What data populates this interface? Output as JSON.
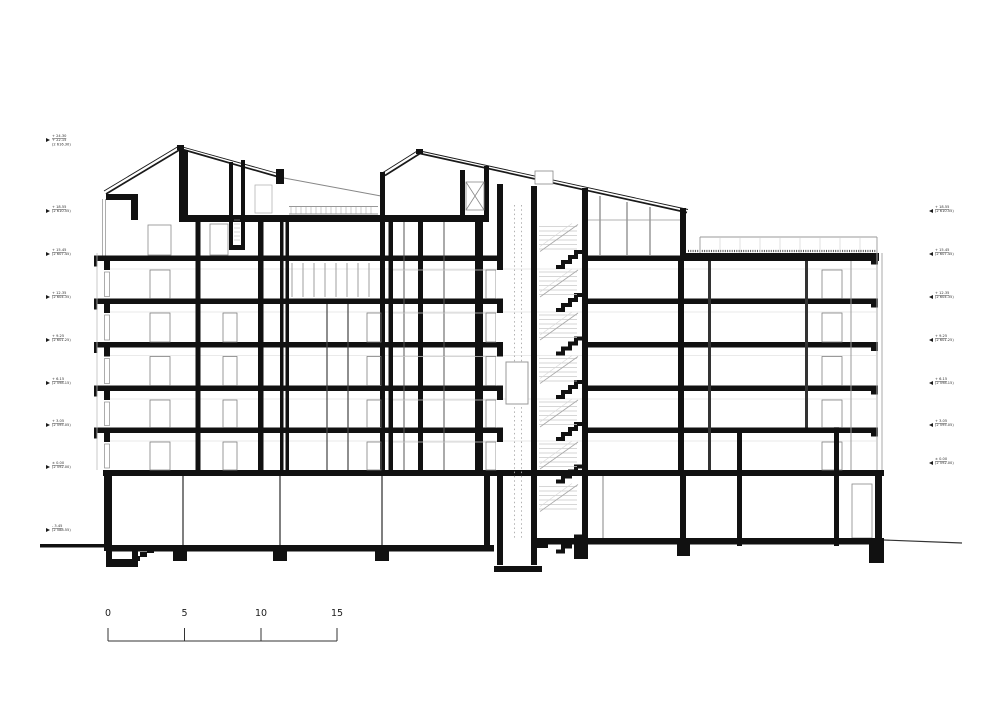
{
  "drawing_title": "building-cross-section",
  "scale_bar": {
    "labels": [
      "0",
      "5",
      "10",
      "15"
    ]
  },
  "levels_left": [
    {
      "a": "+ 24.30",
      "b": "+ 22.15",
      "c": "(2 616.30)"
    },
    {
      "a": "+ 18.55",
      "b": "(2 610.55)"
    },
    {
      "a": "+ 15.45",
      "b": "(2 607.45)"
    },
    {
      "a": "+ 12.35",
      "b": "(2 604.35)"
    },
    {
      "a": "+ 9.25",
      "b": "(2 601.25)"
    },
    {
      "a": "+ 6.15",
      "b": "(2 598.15)"
    },
    {
      "a": "+ 3.05",
      "b": "(2 595.05)"
    },
    {
      "a": "± 0.00",
      "b": "(2 592.00)"
    },
    {
      "a": "- 3.45",
      "b": "(2 588.55)"
    }
  ],
  "levels_right": [
    {
      "a": "+ 18.55",
      "b": "(2 610.55)"
    },
    {
      "a": "+ 15.45",
      "b": "(2 607.45)"
    },
    {
      "a": "+ 12.35",
      "b": "(2 604.35)"
    },
    {
      "a": "+ 9.25",
      "b": "(2 601.25)"
    },
    {
      "a": "+ 6.15",
      "b": "(2 598.15)"
    },
    {
      "a": "+ 3.05",
      "b": "(2 595.05)"
    },
    {
      "a": "± 0.00",
      "b": "(2 592.00)"
    }
  ]
}
